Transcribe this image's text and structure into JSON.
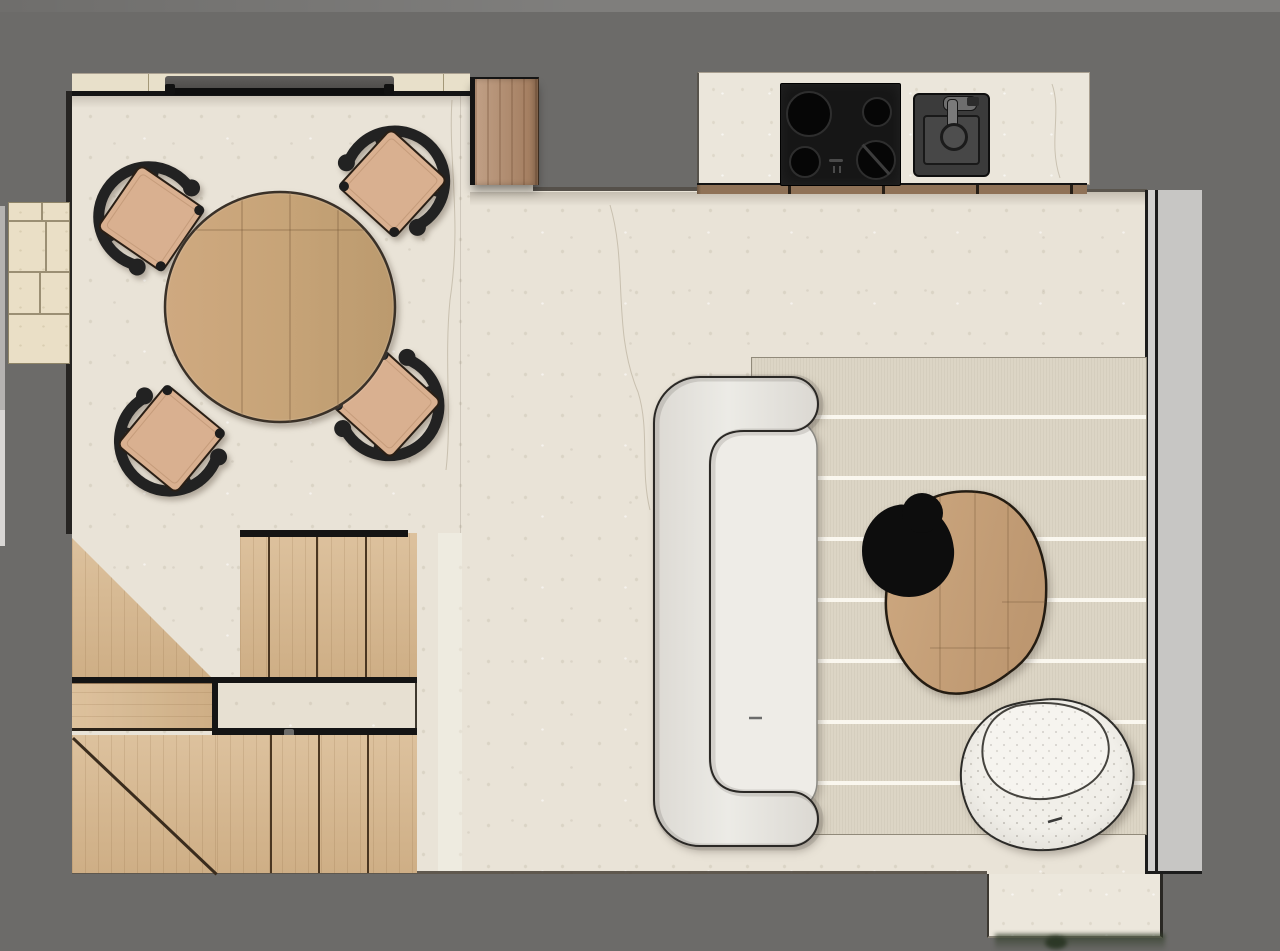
{
  "floorplan": {
    "view": "top-down interior floor plan render",
    "background_color": "#6c6b69",
    "areas": [
      {
        "id": "dining-area",
        "label": "Dining area with limestone floor",
        "floor_color": "#e9e3d7"
      },
      {
        "id": "kitchen",
        "label": "Kitchen counter run with cooktop and sink",
        "counter_color": "#ebe6db"
      },
      {
        "id": "living-area",
        "label": "Living area with striped rug",
        "rug_color": "#dcd5c5"
      },
      {
        "id": "staircase",
        "label": "Staircase with winders and landing",
        "wood_color": "#d8b990"
      }
    ],
    "furniture": [
      {
        "id": "dining-table",
        "label": "Round wooden dining table",
        "color": "#c7a47a"
      },
      {
        "id": "dining-chair-nw",
        "label": "Dining chair top-left",
        "seat_color": "#d9b090",
        "frame_color": "#222222"
      },
      {
        "id": "dining-chair-ne",
        "label": "Dining chair top-right",
        "seat_color": "#d9b090",
        "frame_color": "#222222"
      },
      {
        "id": "dining-chair-sw",
        "label": "Dining chair bottom-left",
        "seat_color": "#d9b090",
        "frame_color": "#222222"
      },
      {
        "id": "dining-chair-se",
        "label": "Dining chair bottom-right",
        "seat_color": "#d9b090",
        "frame_color": "#222222"
      },
      {
        "id": "sofa",
        "label": "Curved cream sofa",
        "color": "#e8e5e0"
      },
      {
        "id": "coffee-table",
        "label": "Organic-shaped wooden coffee table",
        "color": "#c7a077"
      },
      {
        "id": "side-table",
        "label": "Round black side table",
        "color": "#0d0d0d"
      },
      {
        "id": "armchair",
        "label": "Round boucle swivel armchair",
        "color": "#f0eee8"
      },
      {
        "id": "cooktop",
        "label": "Four-burner black cooktop",
        "color": "#161616"
      },
      {
        "id": "sink",
        "label": "Kitchen sink with faucet",
        "color": "#3b3b3b"
      },
      {
        "id": "tall-cabinet",
        "label": "Tall wood cabinet",
        "color": "#b38b6b"
      },
      {
        "id": "rug",
        "label": "Striped area rug",
        "color": "#dcd5c5"
      }
    ],
    "openings": [
      {
        "id": "dining-window",
        "label": "Window on top wall of dining area"
      },
      {
        "id": "glass-wall",
        "label": "Full-height glazing along right side"
      },
      {
        "id": "entry-step",
        "label": "Entry step at bottom right"
      },
      {
        "id": "exterior-tiles",
        "label": "Exterior stone tile patch at left"
      }
    ]
  }
}
